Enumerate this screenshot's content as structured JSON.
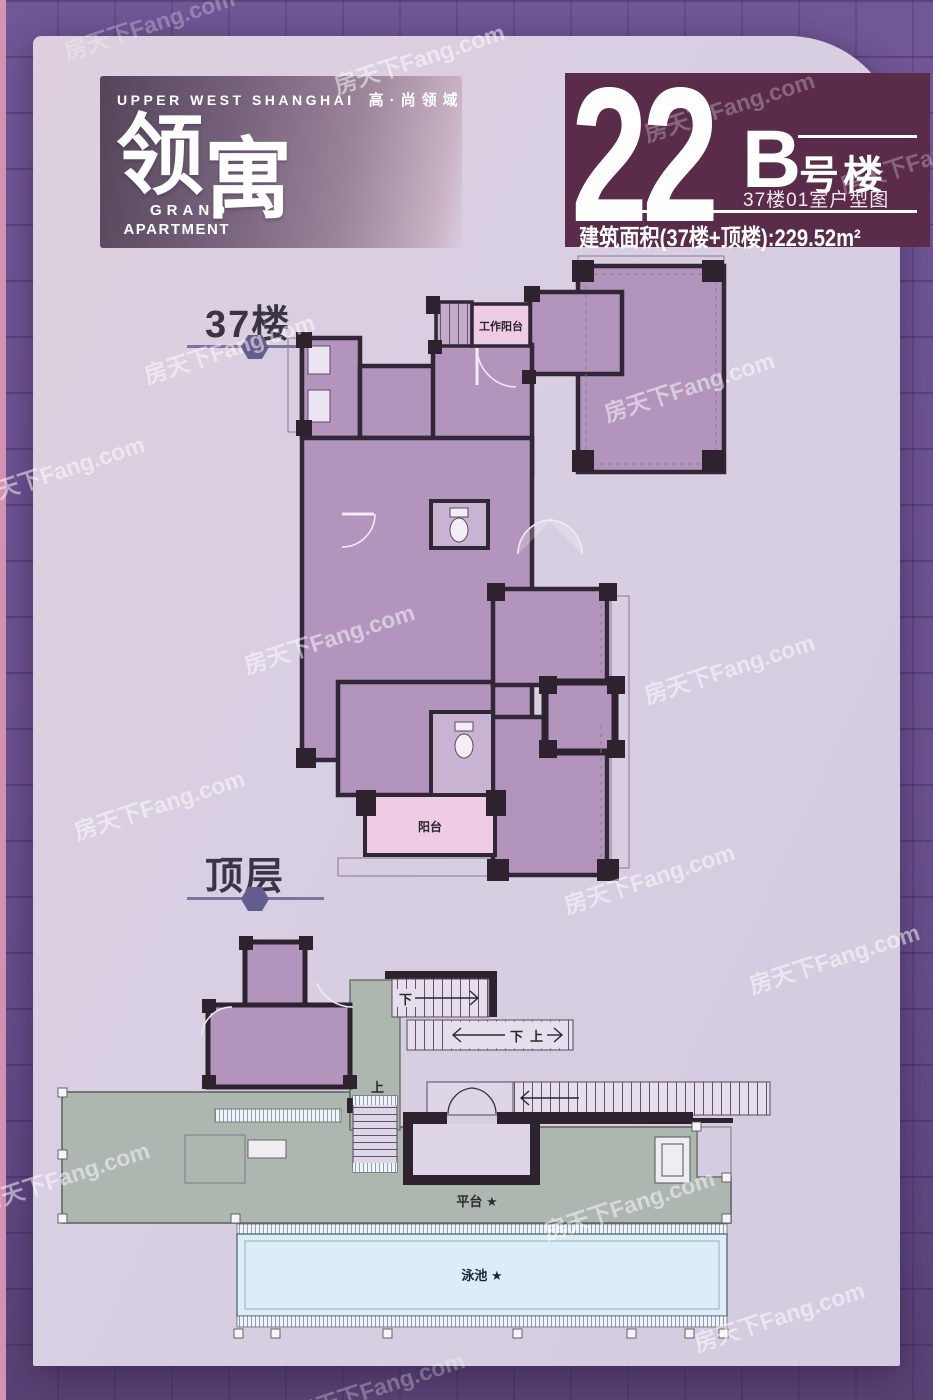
{
  "watermark": "房天下Fang.com",
  "header": {
    "tagline_en": "UPPER WEST SHANGHAI",
    "tagline_cn": "高·尚领域",
    "logo_char_1": "领",
    "logo_char_2": "寓",
    "logo_sub_1": "GRAND",
    "logo_sub_2": "APARTMENT"
  },
  "banner": {
    "number": "22",
    "letter": "B",
    "letter_suffix": "号楼",
    "subtitle": "37楼01室户型图",
    "area": "建筑面积(37楼+顶楼):229.52m²"
  },
  "floors": [
    {
      "label": "37楼"
    },
    {
      "label": "顶层"
    }
  ],
  "plan37": {
    "work_balcony": "工作阳台",
    "balcony": "阳台"
  },
  "planTop": {
    "stair1_down": "下",
    "stair2_down": "下",
    "stair2_up": "上",
    "stair3_up": "上",
    "platform": "平台 ★",
    "pool": "泳池 ★"
  },
  "colors": {
    "background": "#6b5290",
    "card": "#d9cfe2",
    "banner": "#5b2c49",
    "room_fill": "#b294bd",
    "wall": "#2d222e",
    "balcony_pink": "#eecde4",
    "terrace_gray": "#aeb6b0",
    "pool_blue": "#dbeef8",
    "accent_line": "#7b73a0"
  }
}
